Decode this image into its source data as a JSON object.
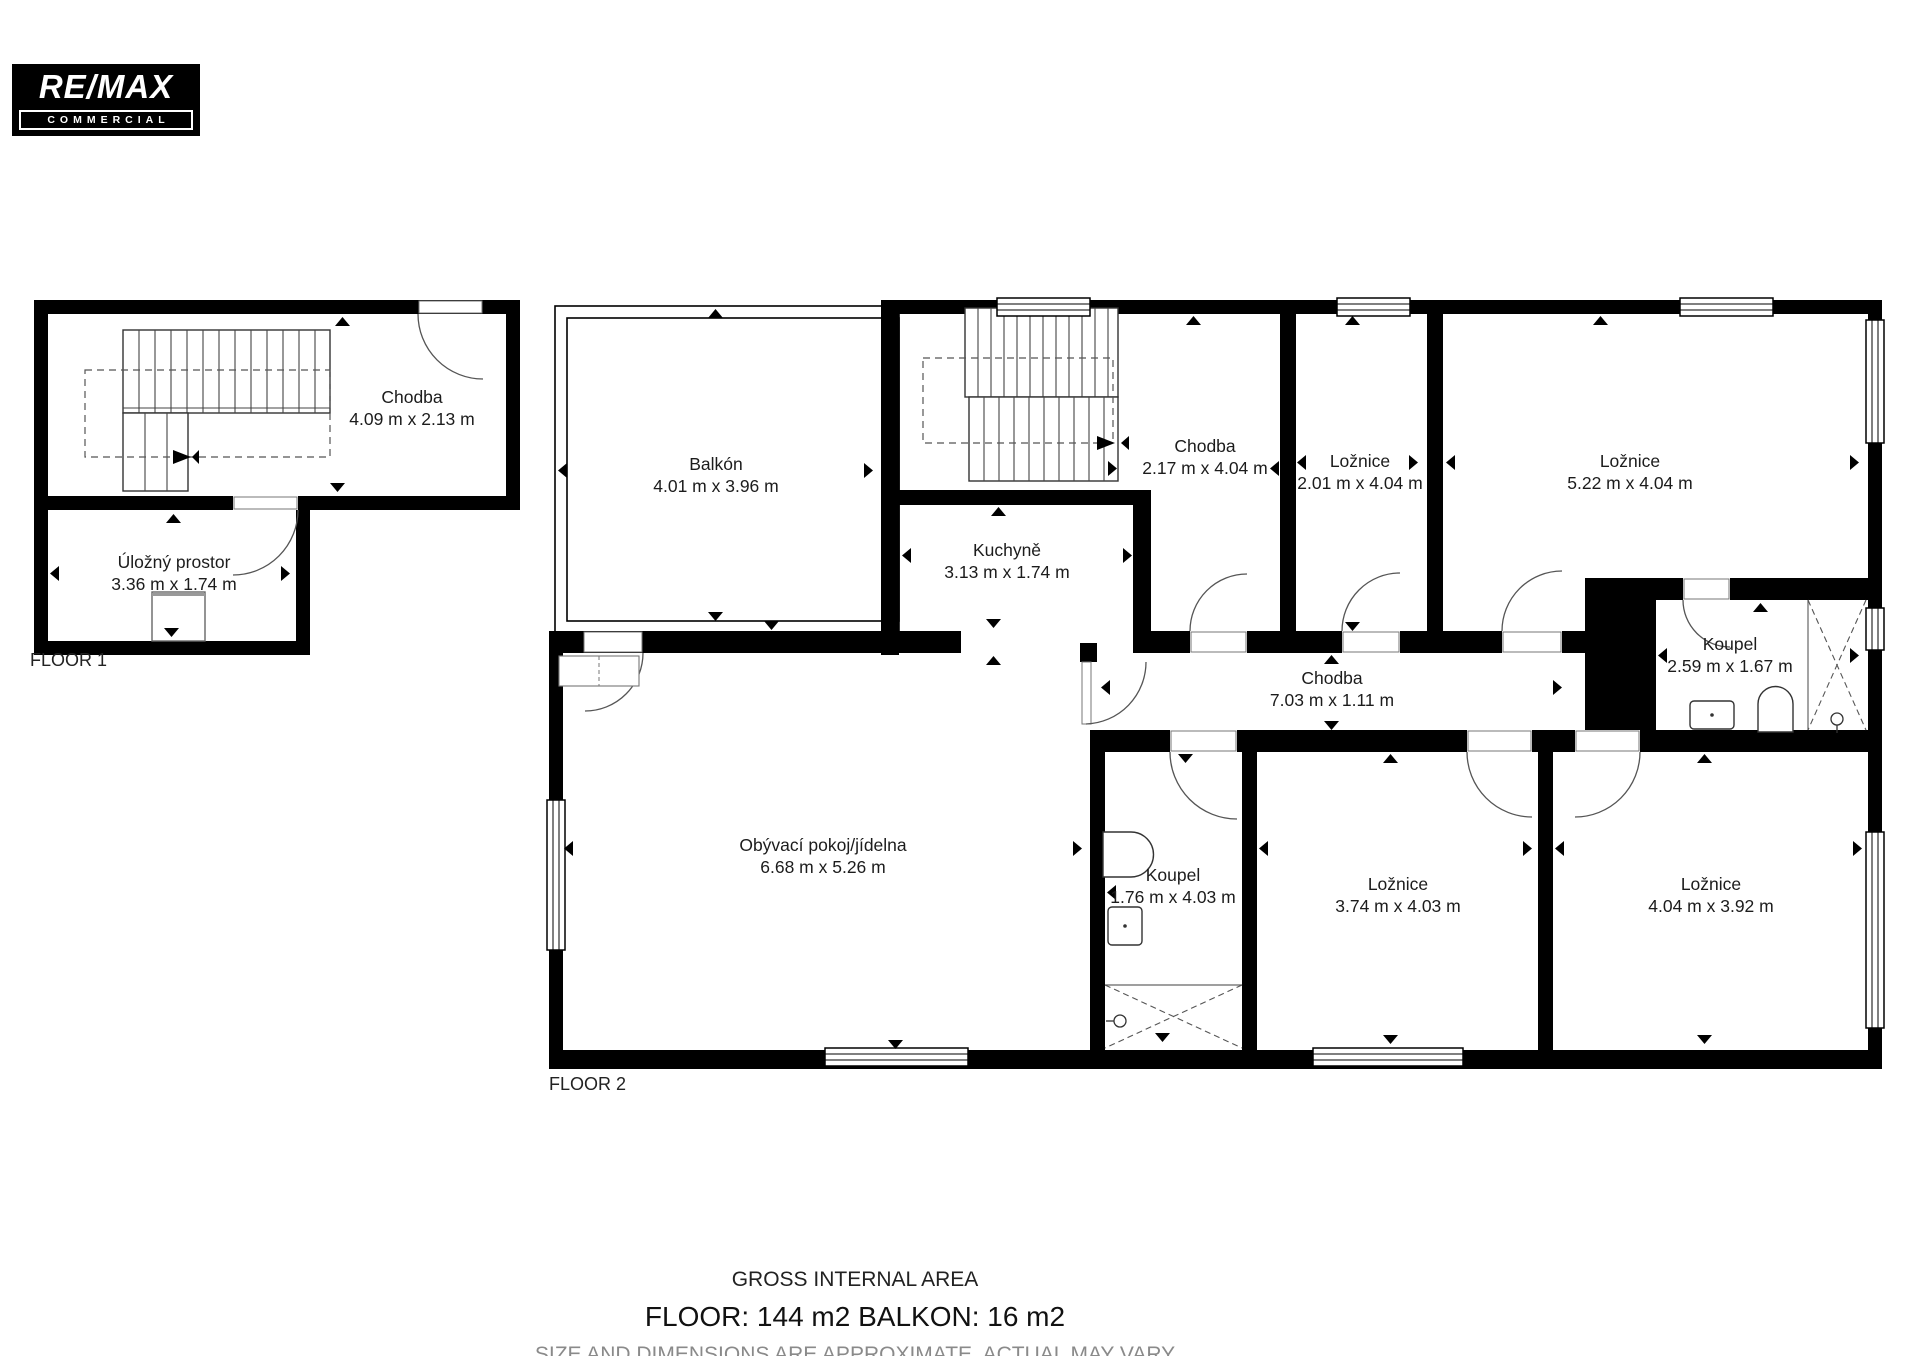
{
  "logo": {
    "brand": "RE/MAX",
    "sub": "COMMERCIAL"
  },
  "floor1": {
    "label": "FLOOR 1",
    "rooms": {
      "chodba": {
        "name": "Chodba",
        "dims": "4.09 m x 2.13 m"
      },
      "ulozny_prostor": {
        "name": "Úložný prostor",
        "dims": "3.36 m x 1.74 m"
      }
    }
  },
  "floor2": {
    "label": "FLOOR 2",
    "rooms": {
      "balkon": {
        "name": "Balkón",
        "dims": "4.01 m x 3.96 m"
      },
      "chodba_schody": {
        "name": "Chodba",
        "dims": "2.17 m x 4.04 m"
      },
      "loznice_mala": {
        "name": "Ložnice",
        "dims": "2.01 m x 4.04 m"
      },
      "loznice_velka": {
        "name": "Ložnice",
        "dims": "5.22 m x 4.04 m"
      },
      "kuchyne": {
        "name": "Kuchyně",
        "dims": "3.13 m x 1.74 m"
      },
      "chodba": {
        "name": "Chodba",
        "dims": "7.03 m x 1.11 m"
      },
      "koupel_horni": {
        "name": "Koupel",
        "dims": "2.59 m x 1.67 m"
      },
      "obyvaci_pokoj": {
        "name": "Obývací pokoj/jídelna",
        "dims": "6.68 m x 5.26 m"
      },
      "koupel_dolni": {
        "name": "Koupel",
        "dims": "1.76 m x 4.03 m"
      },
      "loznice_stredni": {
        "name": "Ložnice",
        "dims": "3.74 m x 4.03 m"
      },
      "loznice_prava": {
        "name": "Ložnice",
        "dims": "4.04 m x 3.92 m"
      }
    }
  },
  "footer": {
    "line1": "GROSS INTERNAL AREA",
    "line2": "FLOOR: 144 m2 BALKON: 16 m2",
    "line3": "SIZE AND DIMENSIONS ARE APPROXIMATE, ACTUAL MAY VARY"
  },
  "colors": {
    "wall": "#000000",
    "background": "#ffffff",
    "muted_text": "#8a8a8a"
  }
}
